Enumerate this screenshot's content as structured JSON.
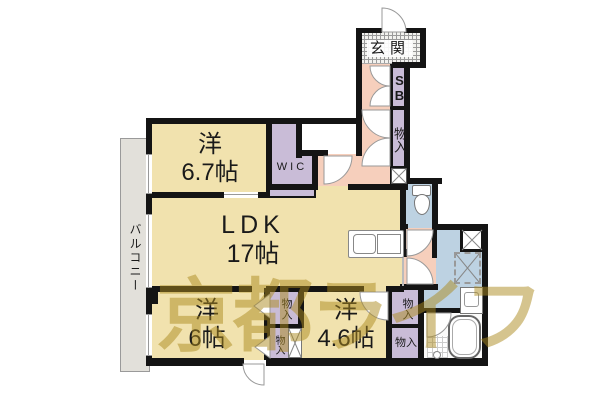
{
  "watermark": {
    "text": "京都ライフ"
  },
  "rooms": {
    "entrance": {
      "label": "玄関"
    },
    "shoe_box": {
      "label": "SB"
    },
    "hall_storage": {
      "label": "物入"
    },
    "wic": {
      "label": "WIC"
    },
    "bedroom_67": {
      "type": "洋",
      "size": "6.7帖"
    },
    "ldk": {
      "type": "LDK",
      "size": "17帖"
    },
    "balcony": {
      "label": "バルコニー"
    },
    "bedroom_6": {
      "type": "洋",
      "size": "6帖"
    },
    "bedroom_46": {
      "type": "洋",
      "size": "4.6帖"
    },
    "storage_6_upper": {
      "label": "物入"
    },
    "storage_6_lower": {
      "label": "物入"
    },
    "storage_46_upper": {
      "label": "物入"
    },
    "storage_46_lower": {
      "label": "物入"
    }
  },
  "colors": {
    "room_tan": "#f1e2ae",
    "closet_purple": "#c9bcd7",
    "hall_pink": "#f6cfbc",
    "water_blue": "#bdd2e2",
    "balcony_gray": "#e2e0da",
    "wall_black": "#141414",
    "watermark_khaki": "#ac8a1e"
  }
}
